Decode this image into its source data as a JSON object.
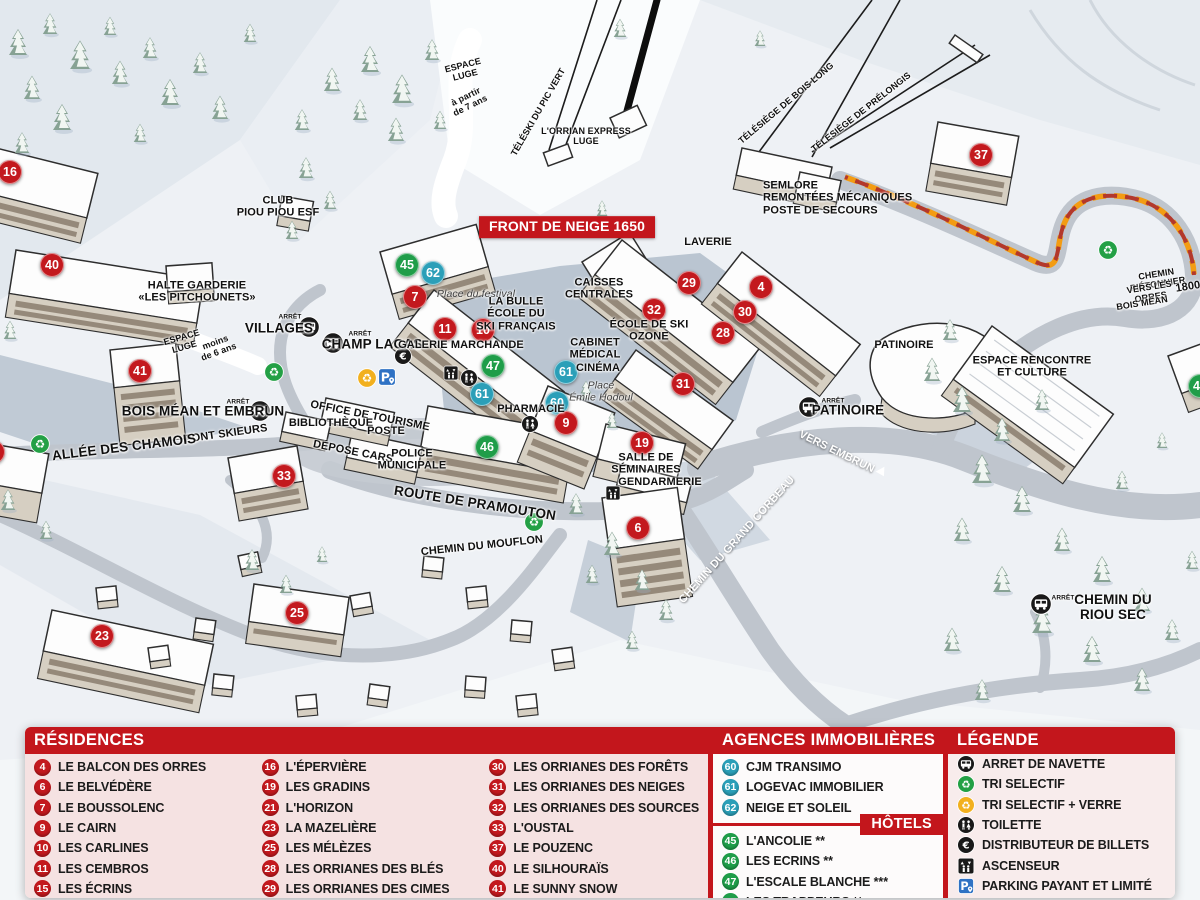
{
  "colors": {
    "marker_red": "#c3191e",
    "marker_teal": "#2b9fb8",
    "marker_green": "#1f9d49",
    "header_red": "#c3161c",
    "path_orange": "#f39c12",
    "panel_pink": "#f5e2e2"
  },
  "map": {
    "markers": [
      {
        "n": "16",
        "x": 10,
        "y": 172,
        "c": "#c3191e"
      },
      {
        "n": "40",
        "x": 52,
        "y": 265,
        "c": "#c3191e"
      },
      {
        "n": "41",
        "x": 140,
        "y": 371,
        "c": "#c3191e"
      },
      {
        "n": "1",
        "x": -7,
        "y": 452,
        "c": "#c3191e"
      },
      {
        "n": "33",
        "x": 284,
        "y": 476,
        "c": "#c3191e"
      },
      {
        "n": "23",
        "x": 102,
        "y": 636,
        "c": "#c3191e"
      },
      {
        "n": "25",
        "x": 297,
        "y": 613,
        "c": "#c3191e"
      },
      {
        "n": "45",
        "x": 407,
        "y": 265,
        "c": "#1f9d49"
      },
      {
        "n": "62",
        "x": 433,
        "y": 273,
        "c": "#2b9fb8"
      },
      {
        "n": "7",
        "x": 415,
        "y": 297,
        "c": "#c3191e"
      },
      {
        "n": "11",
        "x": 445,
        "y": 329,
        "c": "#c3191e"
      },
      {
        "n": "10",
        "x": 483,
        "y": 330,
        "c": "#c3191e"
      },
      {
        "n": "47",
        "x": 493,
        "y": 366,
        "c": "#1f9d49"
      },
      {
        "n": "61",
        "x": 482,
        "y": 394,
        "c": "#2b9fb8"
      },
      {
        "n": "61",
        "x": 566,
        "y": 372,
        "c": "#2b9fb8"
      },
      {
        "n": "60",
        "x": 557,
        "y": 403,
        "c": "#2b9fb8"
      },
      {
        "n": "9",
        "x": 566,
        "y": 423,
        "c": "#c3191e"
      },
      {
        "n": "46",
        "x": 487,
        "y": 447,
        "c": "#1f9d49"
      },
      {
        "n": "29",
        "x": 689,
        "y": 283,
        "c": "#c3191e"
      },
      {
        "n": "4",
        "x": 761,
        "y": 287,
        "c": "#c3191e"
      },
      {
        "n": "32",
        "x": 654,
        "y": 310,
        "c": "#c3191e"
      },
      {
        "n": "30",
        "x": 745,
        "y": 312,
        "c": "#c3191e"
      },
      {
        "n": "28",
        "x": 723,
        "y": 333,
        "c": "#c3191e"
      },
      {
        "n": "31",
        "x": 683,
        "y": 384,
        "c": "#c3191e"
      },
      {
        "n": "19",
        "x": 642,
        "y": 443,
        "c": "#c3191e"
      },
      {
        "n": "6",
        "x": 638,
        "y": 528,
        "c": "#c3191e"
      },
      {
        "n": "37",
        "x": 981,
        "y": 155,
        "c": "#c3191e"
      },
      {
        "n": "49",
        "x": 1200,
        "y": 386,
        "c": "#1f9d49"
      }
    ],
    "icons": [
      {
        "icon": "bus-icon",
        "x": 309,
        "y": 327,
        "cls": "i22"
      },
      {
        "icon": "bus-icon",
        "x": 333,
        "y": 343,
        "cls": "i22"
      },
      {
        "icon": "bus-icon",
        "x": 260,
        "y": 411,
        "cls": "i22"
      },
      {
        "icon": "bus-icon",
        "x": 809,
        "y": 407,
        "cls": "i22"
      },
      {
        "icon": "bus-icon",
        "x": 1041,
        "y": 604,
        "cls": "i22"
      },
      {
        "icon": "recycle-icon",
        "x": 274,
        "y": 372,
        "cls": "green"
      },
      {
        "icon": "recycle-icon",
        "x": 534,
        "y": 522,
        "cls": "green"
      },
      {
        "icon": "recycle-icon",
        "x": 1108,
        "y": 250,
        "cls": "green"
      },
      {
        "icon": "recycle-icon",
        "x": 40,
        "y": 444,
        "cls": "green"
      },
      {
        "icon": "recycle-icon",
        "x": 367,
        "y": 378,
        "cls": "yellow"
      },
      {
        "icon": "parking-icon",
        "x": 387,
        "y": 377,
        "cls": "i20"
      },
      {
        "icon": "euro-icon",
        "x": 403,
        "y": 356,
        "cls": "i18"
      },
      {
        "icon": "toilet-icon",
        "x": 469,
        "y": 378,
        "cls": "i18"
      },
      {
        "icon": "toilet-icon",
        "x": 530,
        "y": 424,
        "cls": "i18"
      },
      {
        "icon": "elevator-icon",
        "x": 451,
        "y": 373,
        "cls": "i16"
      },
      {
        "icon": "elevator-icon",
        "x": 613,
        "y": 493,
        "cls": "i16"
      }
    ],
    "labels": [
      {
        "text": "ESPACE\nLUGE",
        "x": 464,
        "y": 70,
        "rot": -14,
        "cls": "sm"
      },
      {
        "text": "à partir\nde 7 ans",
        "x": 468,
        "y": 101,
        "rot": -26,
        "cls": "sm"
      },
      {
        "text": "TÉLÉSKI DU PIC VERT",
        "x": 538,
        "y": 112,
        "rot": -60,
        "cls": "sm"
      },
      {
        "text": "L'ORRIAN EXPRESS\nLUGE",
        "x": 586,
        "y": 136,
        "cls": "sm"
      },
      {
        "text": "TÉLÉSIÈGE DE BOIS LONG",
        "x": 786,
        "y": 103,
        "rot": -40,
        "cls": "sm"
      },
      {
        "text": "TÉLÉSIÈGE DE PRÉLONGIS",
        "x": 861,
        "y": 112,
        "rot": -38,
        "cls": "sm"
      },
      {
        "text": "SEMLORE\nREMONTÉES MÉCANIQUES\nPOSTE DE SECOURS",
        "x": 763,
        "y": 198,
        "cls": "left"
      },
      {
        "text": "FRONT DE NEIGE 1650",
        "x": 567,
        "y": 227,
        "cls": "banner"
      },
      {
        "text": "CLUB\nPIOU PIOU ESF",
        "x": 278,
        "y": 207
      },
      {
        "text": "HALTE GARDERIE\n«LES PITCHOUNETS»",
        "x": 197,
        "y": 292
      },
      {
        "text": "ARRÊT",
        "x": 290,
        "y": 317,
        "cls": "tiny"
      },
      {
        "text": "VILLAGES",
        "x": 279,
        "y": 328,
        "cls": "lg"
      },
      {
        "text": "ARRÊT",
        "x": 360,
        "y": 334,
        "cls": "tiny"
      },
      {
        "text": "CHAMP LACAS",
        "x": 372,
        "y": 344,
        "cls": "lg"
      },
      {
        "text": "ESPACE\nLUGE",
        "x": 183,
        "y": 342,
        "rot": -16,
        "cls": "sm"
      },
      {
        "text": "moins\nde 6 ans",
        "x": 217,
        "y": 347,
        "rot": -20,
        "cls": "sm"
      },
      {
        "text": "Place du festival",
        "x": 476,
        "y": 295,
        "cls": "italic"
      },
      {
        "text": "LA BULLE\nÉCOLE DU\nSKI FRANÇAIS",
        "x": 516,
        "y": 314
      },
      {
        "text": "GALERIE MARCHANDE",
        "x": 461,
        "y": 345
      },
      {
        "text": "CAISSES\nCENTRALES",
        "x": 599,
        "y": 289
      },
      {
        "text": "LAVERIE",
        "x": 708,
        "y": 242
      },
      {
        "text": "ÉCOLE DE SKI\nOZONE",
        "x": 649,
        "y": 331
      },
      {
        "text": "CABINET\nMÉDICAL",
        "x": 595,
        "y": 349
      },
      {
        "text": "CINÉMA",
        "x": 598,
        "y": 368
      },
      {
        "text": "Place\nÉmile Hodoul",
        "x": 601,
        "y": 392,
        "cls": "italic"
      },
      {
        "text": "PHARMACIE",
        "x": 531,
        "y": 409
      },
      {
        "text": "OFFICE DE TOURISME",
        "x": 370,
        "y": 416,
        "rot": 11
      },
      {
        "text": "BIBLIOTHÈQUE",
        "x": 331,
        "y": 423
      },
      {
        "text": "POSTE",
        "x": 386,
        "y": 431
      },
      {
        "text": "DÉPOSE CARS",
        "x": 353,
        "y": 452,
        "rot": 11
      },
      {
        "text": "POLICE\nMUNICIPALE",
        "x": 412,
        "y": 460
      },
      {
        "text": "ARRÊT",
        "x": 238,
        "y": 402,
        "cls": "tiny"
      },
      {
        "text": "BOIS MÉAN ET EMBRUN",
        "x": 203,
        "y": 411,
        "cls": "lg"
      },
      {
        "text": "PONT SKIEURS",
        "x": 226,
        "y": 434,
        "rot": -8
      },
      {
        "text": "ALLÉE DES CHAMOIS",
        "x": 124,
        "y": 447,
        "rot": -7,
        "cls": "lg"
      },
      {
        "text": "ROUTE DE PRAMOUTON",
        "x": 475,
        "y": 503,
        "rot": 9,
        "cls": "lg"
      },
      {
        "text": "CHEMIN DU MOUFLON",
        "x": 482,
        "y": 546,
        "rot": -6
      },
      {
        "text": "SALLE DE\nSÉMINAIRES",
        "x": 646,
        "y": 464
      },
      {
        "text": "GENDARMERIE",
        "x": 660,
        "y": 482
      },
      {
        "text": "CHEMIN DU GRAND CORBEAU",
        "x": 737,
        "y": 540,
        "rot": -48,
        "cls": "white"
      },
      {
        "text": "VERS EMBRUN",
        "x": 843,
        "y": 455,
        "rot": 26,
        "cls": "white arrow"
      },
      {
        "text": "PATINOIRE",
        "x": 904,
        "y": 345
      },
      {
        "text": "ARRÊT",
        "x": 833,
        "y": 401,
        "cls": "tiny"
      },
      {
        "text": "PATINOIRE",
        "x": 848,
        "y": 410,
        "cls": "lg"
      },
      {
        "text": "ESPACE RENCONTRE\nET CULTURE",
        "x": 1032,
        "y": 367
      },
      {
        "text": "CHEMIN PIÉTONNIER",
        "x": 1157,
        "y": 279,
        "rot": -9,
        "cls": "sm"
      },
      {
        "text": "VERS LES ORRES",
        "x": 1150,
        "y": 292,
        "rot": -9,
        "cls": "sm"
      },
      {
        "text": "1800",
        "x": 1188,
        "y": 287,
        "rot": -9
      },
      {
        "text": "BOIS MÉAN",
        "x": 1142,
        "y": 303,
        "rot": -9,
        "cls": "sm"
      },
      {
        "text": "ARRÊT",
        "x": 1063,
        "y": 598,
        "cls": "tiny"
      },
      {
        "text": "CHEMIN DU RIOU SEC",
        "x": 1113,
        "y": 607,
        "cls": "lg"
      }
    ]
  },
  "panel": {
    "residences": {
      "title": "RÉSIDENCES",
      "columns": [
        [
          {
            "n": "4",
            "label": "LE BALCON DES ORRES"
          },
          {
            "n": "6",
            "label": "LE BELVÉDÈRE"
          },
          {
            "n": "7",
            "label": "LE BOUSSOLENC"
          },
          {
            "n": "9",
            "label": "LE CAIRN"
          },
          {
            "n": "10",
            "label": "LES CARLINES"
          },
          {
            "n": "11",
            "label": "LES CEMBROS"
          },
          {
            "n": "15",
            "label": "LES ÉCRINS"
          }
        ],
        [
          {
            "n": "16",
            "label": "L'ÉPERVIÈRE"
          },
          {
            "n": "19",
            "label": "LES GRADINS"
          },
          {
            "n": "21",
            "label": "L'HORIZON"
          },
          {
            "n": "23",
            "label": "LA MAZELIÈRE"
          },
          {
            "n": "25",
            "label": "LES MÉLÈZES"
          },
          {
            "n": "28",
            "label": "LES ORRIANES DES BLÉS"
          },
          {
            "n": "29",
            "label": "LES ORRIANES DES CIMES"
          }
        ],
        [
          {
            "n": "30",
            "label": "LES ORRIANES DES FORÊTS"
          },
          {
            "n": "31",
            "label": "LES ORRIANES DES NEIGES"
          },
          {
            "n": "32",
            "label": "LES ORRIANES DES SOURCES"
          },
          {
            "n": "33",
            "label": "L'OUSTAL"
          },
          {
            "n": "37",
            "label": "LE POUZENC"
          },
          {
            "n": "40",
            "label": "LE SILHOURAÏS"
          },
          {
            "n": "41",
            "label": "LE SUNNY SNOW"
          }
        ]
      ]
    },
    "agences": {
      "title": "AGENCES IMMOBILIÈRES",
      "items": [
        {
          "n": "60",
          "label": "CJM TRANSIMO",
          "c": "#2b9fb8"
        },
        {
          "n": "61",
          "label": "LOGEVAC IMMOBILIER",
          "c": "#2b9fb8"
        },
        {
          "n": "62",
          "label": "NEIGE ET SOLEIL",
          "c": "#2b9fb8"
        }
      ]
    },
    "hotels": {
      "title": "HÔTELS",
      "items": [
        {
          "n": "45",
          "label": "L'ANCOLIE **",
          "c": "#1f9d49"
        },
        {
          "n": "46",
          "label": "LES ECRINS **",
          "c": "#1f9d49"
        },
        {
          "n": "47",
          "label": "L'ESCALE BLANCHE ***",
          "c": "#1f9d49"
        },
        {
          "n": "49",
          "label": "LES TRAPPEURS **",
          "c": "#1f9d49"
        }
      ]
    },
    "legende": {
      "title": "LÉGENDE",
      "items": [
        {
          "icon": "bus-icon",
          "label": "ARRET DE NAVETTE"
        },
        {
          "icon": "recycle-icon",
          "cls": "green",
          "label": "TRI SELECTIF"
        },
        {
          "icon": "recycle-icon",
          "cls": "yellow",
          "label": "TRI SELECTIF + VERRE"
        },
        {
          "icon": "toilet-icon",
          "label": "TOILETTE"
        },
        {
          "icon": "euro-icon",
          "label": "DISTRIBUTEUR DE BILLETS"
        },
        {
          "icon": "elevator-icon",
          "label": "ASCENSEUR"
        },
        {
          "icon": "parking-icon",
          "label": "PARKING PAYANT ET LIMITÉ"
        }
      ]
    }
  }
}
